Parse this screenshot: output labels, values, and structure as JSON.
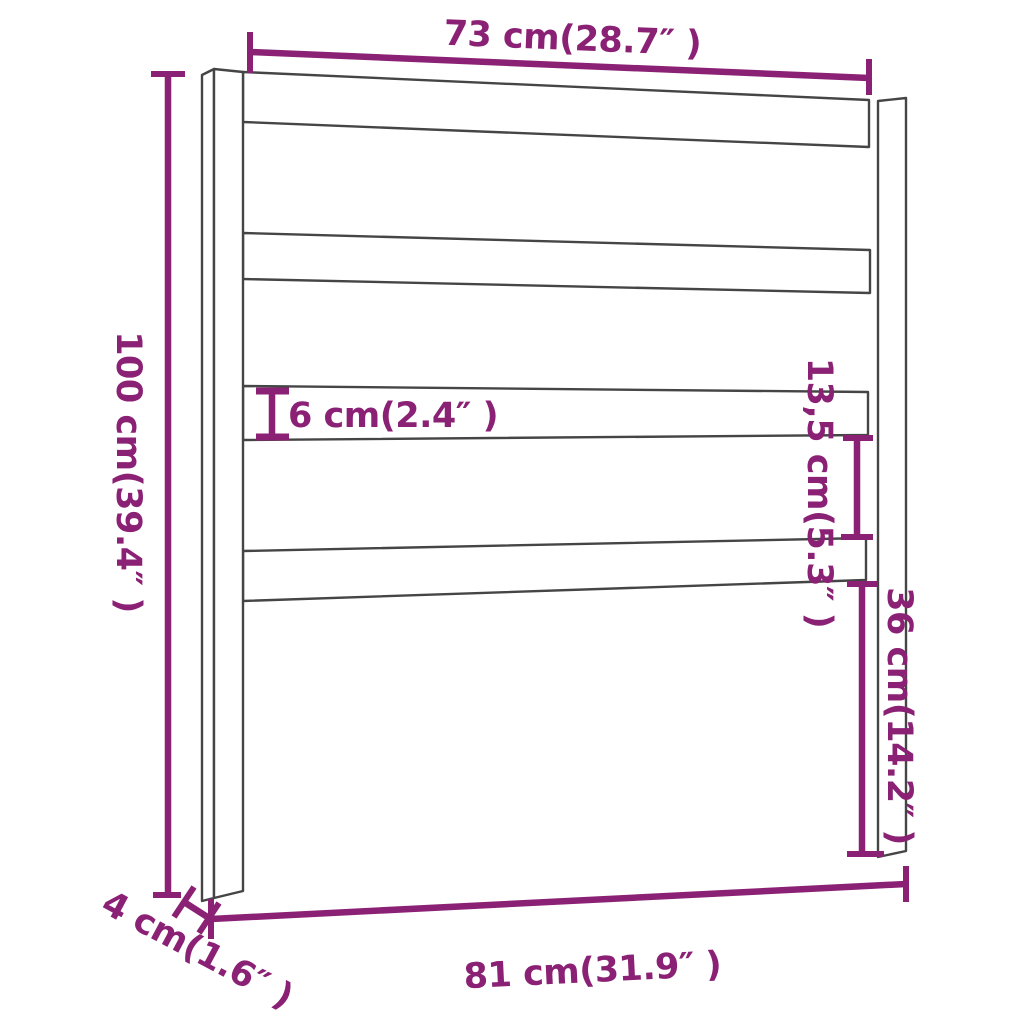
{
  "figure": {
    "type": "product-dimension-diagram",
    "subject": "headboard with two vertical posts and four horizontal slats",
    "slat_count": 4,
    "post_count": 2
  },
  "colors": {
    "accent": "#8B2175",
    "outline": "#454545",
    "background": "#FFFFFF"
  },
  "labels": {
    "width_top": "73 cm(28.7″ )",
    "height_left": "100 cm(39.4″ )",
    "slat_thickness": "6 cm(2.4″ )",
    "slat_gap": "13,5 cm(5.3″ )",
    "lower_height": "36 cm(14.2″ )",
    "width_bottom": "81 cm(31.9″ )",
    "depth": "4 cm(1.6″ )"
  },
  "measurements": [
    {
      "id": "width-top",
      "cm": "73",
      "inch": "28.7",
      "label": "73 cm(28.7″ )"
    },
    {
      "id": "height-left",
      "cm": "100",
      "inch": "39.4",
      "label": "100 cm(39.4″ )"
    },
    {
      "id": "slat-thickness",
      "cm": "6",
      "inch": "2.4",
      "label": "6 cm(2.4″ )"
    },
    {
      "id": "slat-gap",
      "cm": "13,5",
      "inch": "5.3",
      "label": "13,5 cm(5.3″ )"
    },
    {
      "id": "lower-height",
      "cm": "36",
      "inch": "14.2",
      "label": "36 cm(14.2″ )"
    },
    {
      "id": "width-bottom",
      "cm": "81",
      "inch": "31.9",
      "label": "81 cm(31.9″ )"
    },
    {
      "id": "depth",
      "cm": "4",
      "inch": "1.6",
      "label": "4 cm(1.6″ )"
    }
  ]
}
